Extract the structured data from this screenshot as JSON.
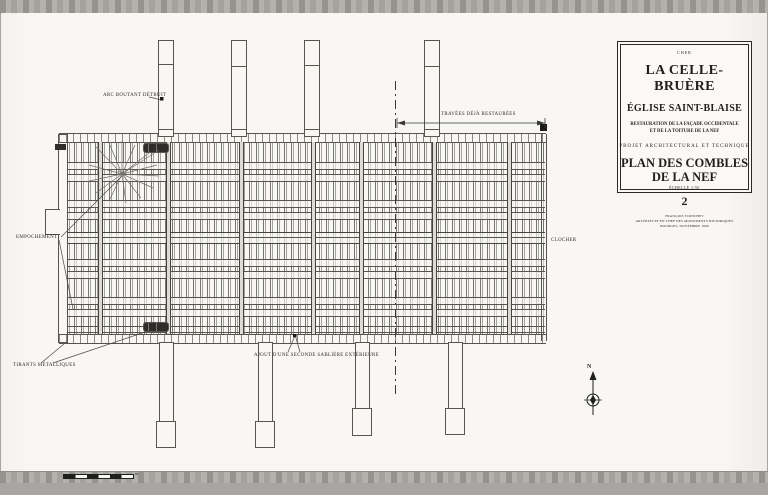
{
  "colors": {
    "ink": "#2b2a26",
    "paper": "#f8f7f3",
    "scan_edge": "#b3b1ac"
  },
  "title_block": {
    "department": "CHER",
    "commune": "LA CELLE-BRUÈRE",
    "building": "ÉGLISE SAINT-BLAISE",
    "project_line1": "RESTAURATION DE LA FAÇADE OCCIDENTALE",
    "project_line2": "ET DE LA TOITURE DE LA NEF",
    "phase": "PROJET ARCHITECTURAL ET TECHNIQUE",
    "title_line1": "PLAN DES COMBLES",
    "title_line2": "DE LA NEF",
    "scale_note": "ÉCHELLE 1/50",
    "sheet_number": "2",
    "credit_line1": "FRANÇOIS VOINCHET",
    "credit_line2": "ARCHITECTE EN CHEF DES MONUMENTS HISTORIQUES",
    "credit_line3": "BOURGES, NOVEMBRE 1996"
  },
  "annotations": {
    "arc_boutant": "ARC BOUTANT DÉTRUIT",
    "travees_restaurees": "TRAVÉES DÉJÀ RESTAURÉES",
    "empochement": "EMPOCHEMENT",
    "tirants": "TIRANTS MÉTALLIQUES",
    "sabliere": "AJOUT D'UNE SECONDE SABLIÈRE EXTÉRIEURE",
    "clocher": "CLOCHER"
  },
  "compass": {
    "north_label": "N"
  },
  "scale_bar": {
    "unit_label": "m"
  }
}
